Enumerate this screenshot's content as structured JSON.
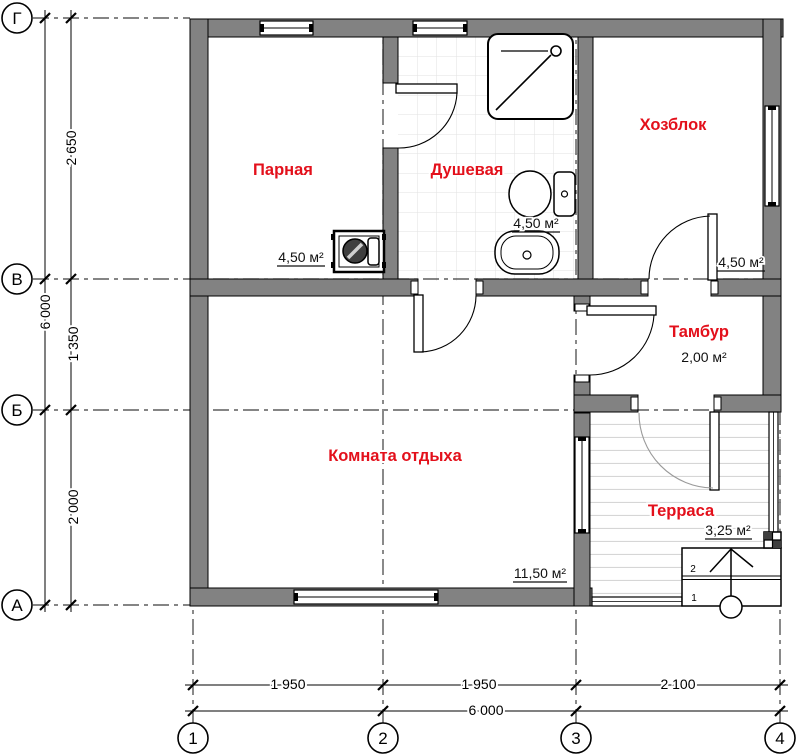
{
  "plan": {
    "rooms": [
      {
        "id": "parnaya",
        "name": "Парная",
        "area": "4,50 м²"
      },
      {
        "id": "dushevaya",
        "name": "Душевая",
        "area": "4,50 м²"
      },
      {
        "id": "hozblok",
        "name": "Хозблок",
        "area": "4,50 м²"
      },
      {
        "id": "tambur",
        "name": "Тамбур",
        "area": "2,00 м²"
      },
      {
        "id": "komnata-otdyha",
        "name": "Комната отдыха",
        "area": "11,50 м²"
      },
      {
        "id": "terrasa",
        "name": "Терраса",
        "area": "3,25 м²"
      }
    ],
    "row_axes": [
      {
        "label": "Г"
      },
      {
        "label": "В"
      },
      {
        "label": "Б"
      },
      {
        "label": "А"
      }
    ],
    "col_axes": [
      {
        "label": "1"
      },
      {
        "label": "2"
      },
      {
        "label": "3"
      },
      {
        "label": "4"
      }
    ],
    "dim_left": {
      "segments": [
        "2 650",
        "1 350",
        "2 000"
      ],
      "total": "6 000"
    },
    "dim_bottom": {
      "segments": [
        "1 950",
        "1 950",
        "2 100"
      ],
      "total": "6 000"
    },
    "steps": {
      "labels": [
        "2",
        "1"
      ]
    }
  },
  "colors": {
    "wall": "#828282",
    "room_label": "#e3101b",
    "area_label": "#111111",
    "tile_grid": "#e2e2e2",
    "plank": "#d6d6d6"
  }
}
